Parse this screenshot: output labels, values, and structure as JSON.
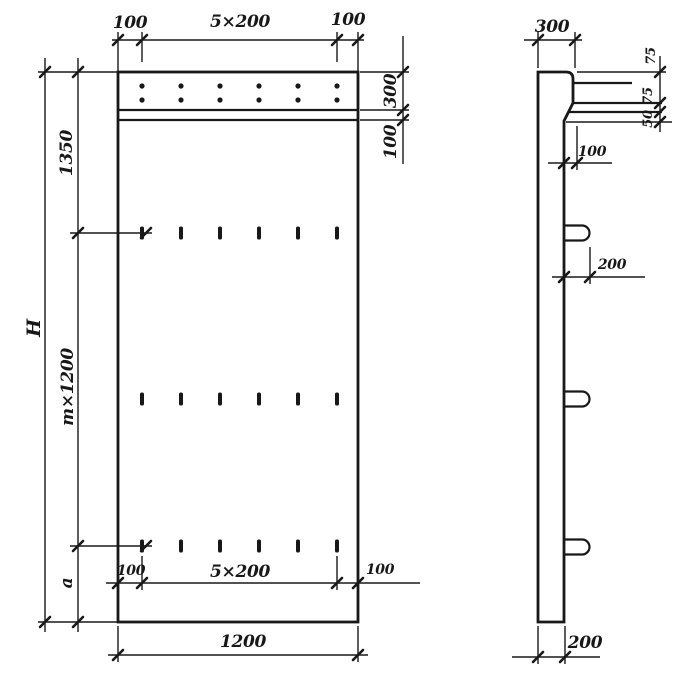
{
  "page": {
    "background": "#ffffff",
    "ink": "#181818",
    "description": "Structural drawing of a flat reinforced wall panel: front elevation and side section with dimension lines"
  },
  "front_view": {
    "label": "front-elevation",
    "dims": {
      "top_left": "100",
      "top_mid": "5×200",
      "top_right": "100",
      "right_band": "300",
      "right_strip": "100",
      "left_overall": "H",
      "left_top": "1350",
      "left_mid": "m×1200",
      "left_bottom": "a",
      "bottom_left": "100",
      "bottom_mid": "5×200",
      "bottom_right": "100",
      "bottom_overall": "1200"
    },
    "features": {
      "dot_rows": 2,
      "dots_per_row": 6,
      "tie_rows": 3,
      "ties_per_row": 6
    }
  },
  "side_view": {
    "label": "side-section",
    "dims": {
      "top": "300",
      "edge_top": "75",
      "edge_mid": "75",
      "edge_bottom": "50",
      "ledge": "100",
      "loop_offset": "200",
      "thickness": "200"
    },
    "features": {
      "lifting_loops": 3
    }
  }
}
